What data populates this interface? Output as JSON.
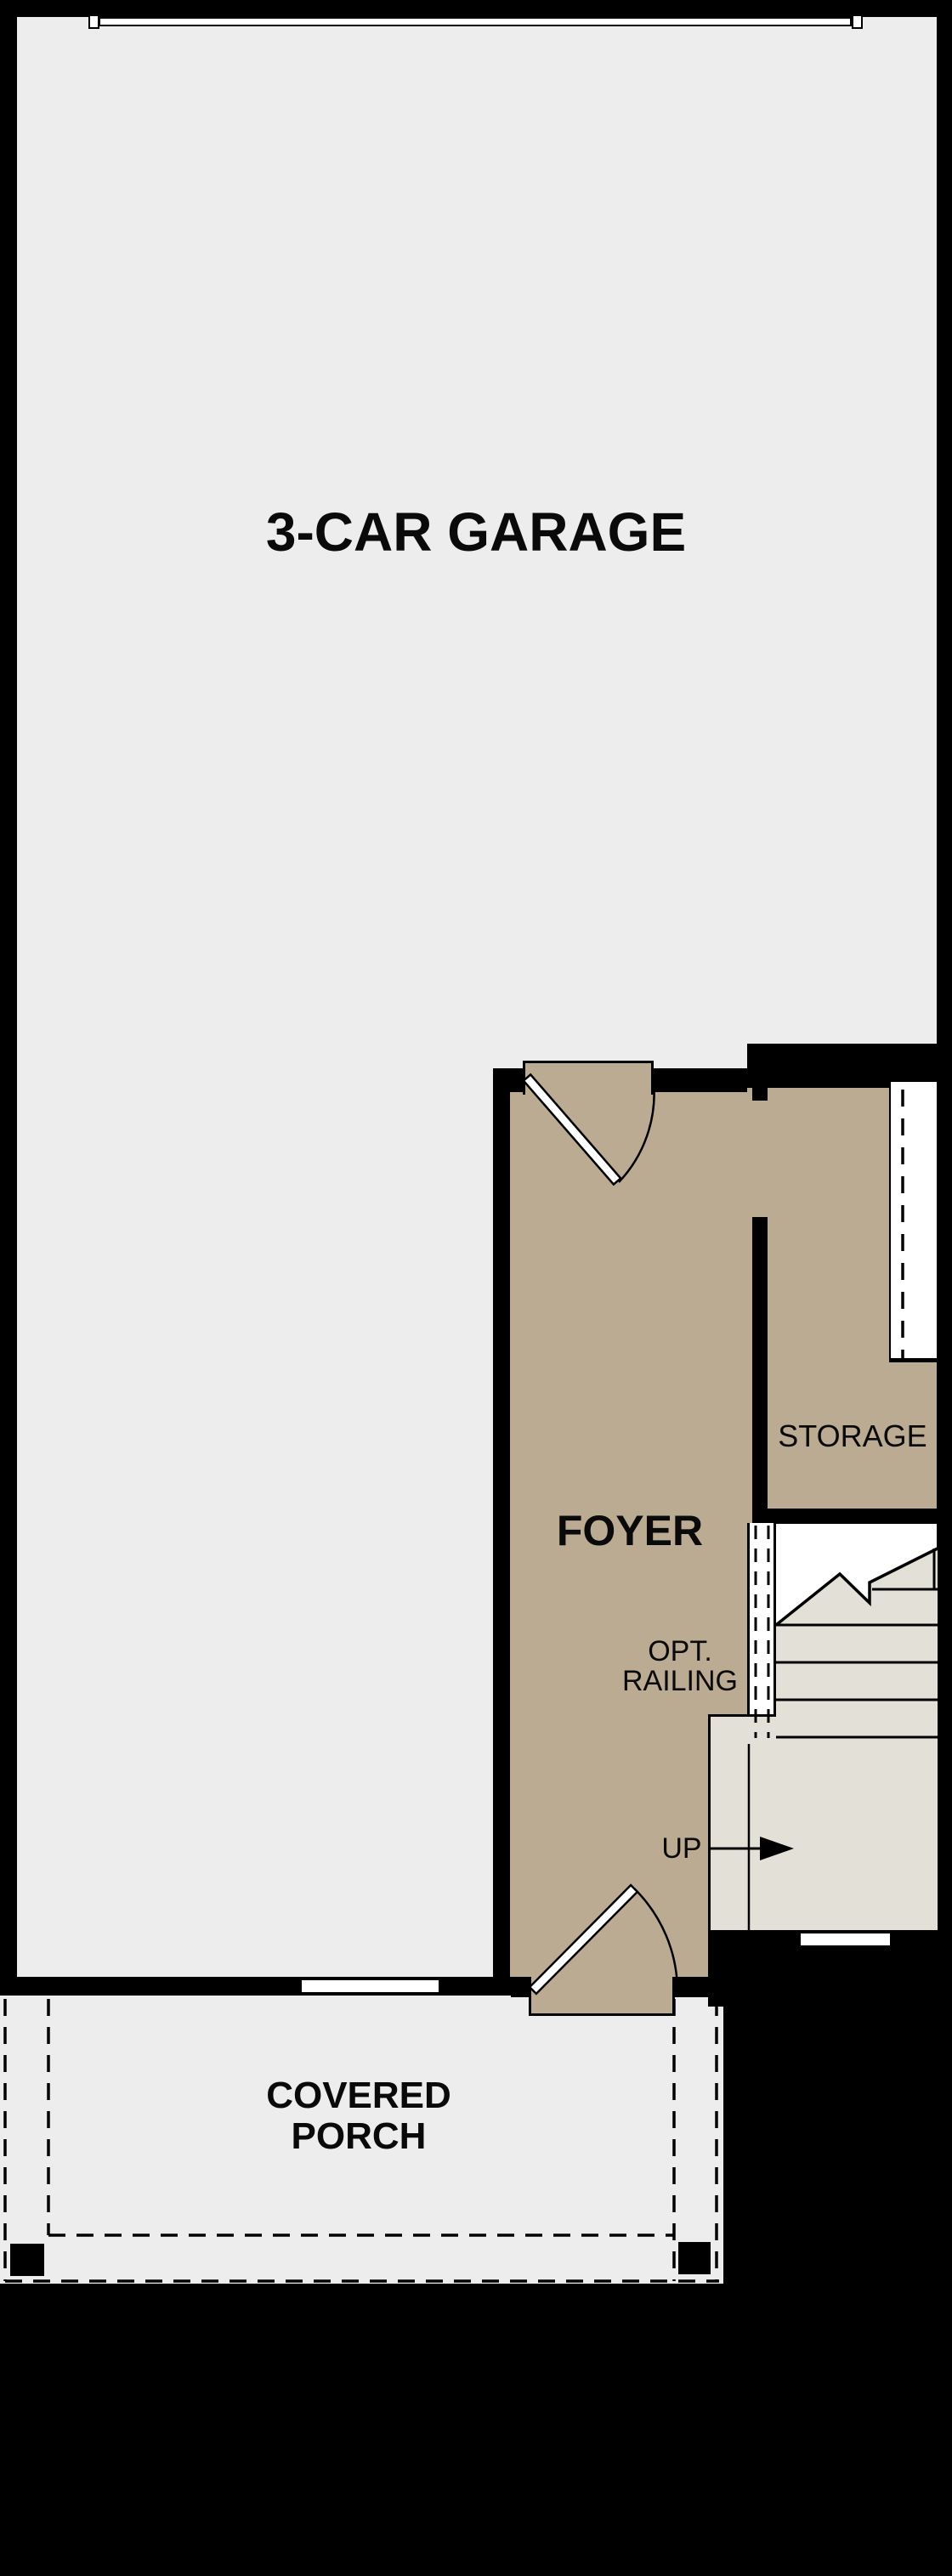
{
  "labels": {
    "garage": "3-CAR GARAGE",
    "foyer": "FOYER",
    "storage": "STORAGE",
    "railing_line1": "OPT.",
    "railing_line2": "RAILING",
    "up": "UP",
    "porch_line1": "COVERED",
    "porch_line2": "PORCH"
  },
  "colors": {
    "background": "#000000",
    "garage_floor": "#ededed",
    "foyer_floor": "#bcab93",
    "stair_floor": "#e3e0d8",
    "porch_floor": "#ededed",
    "wall": "#000000",
    "door_leaf": "#ffffff",
    "text": "#0a0a0a"
  }
}
